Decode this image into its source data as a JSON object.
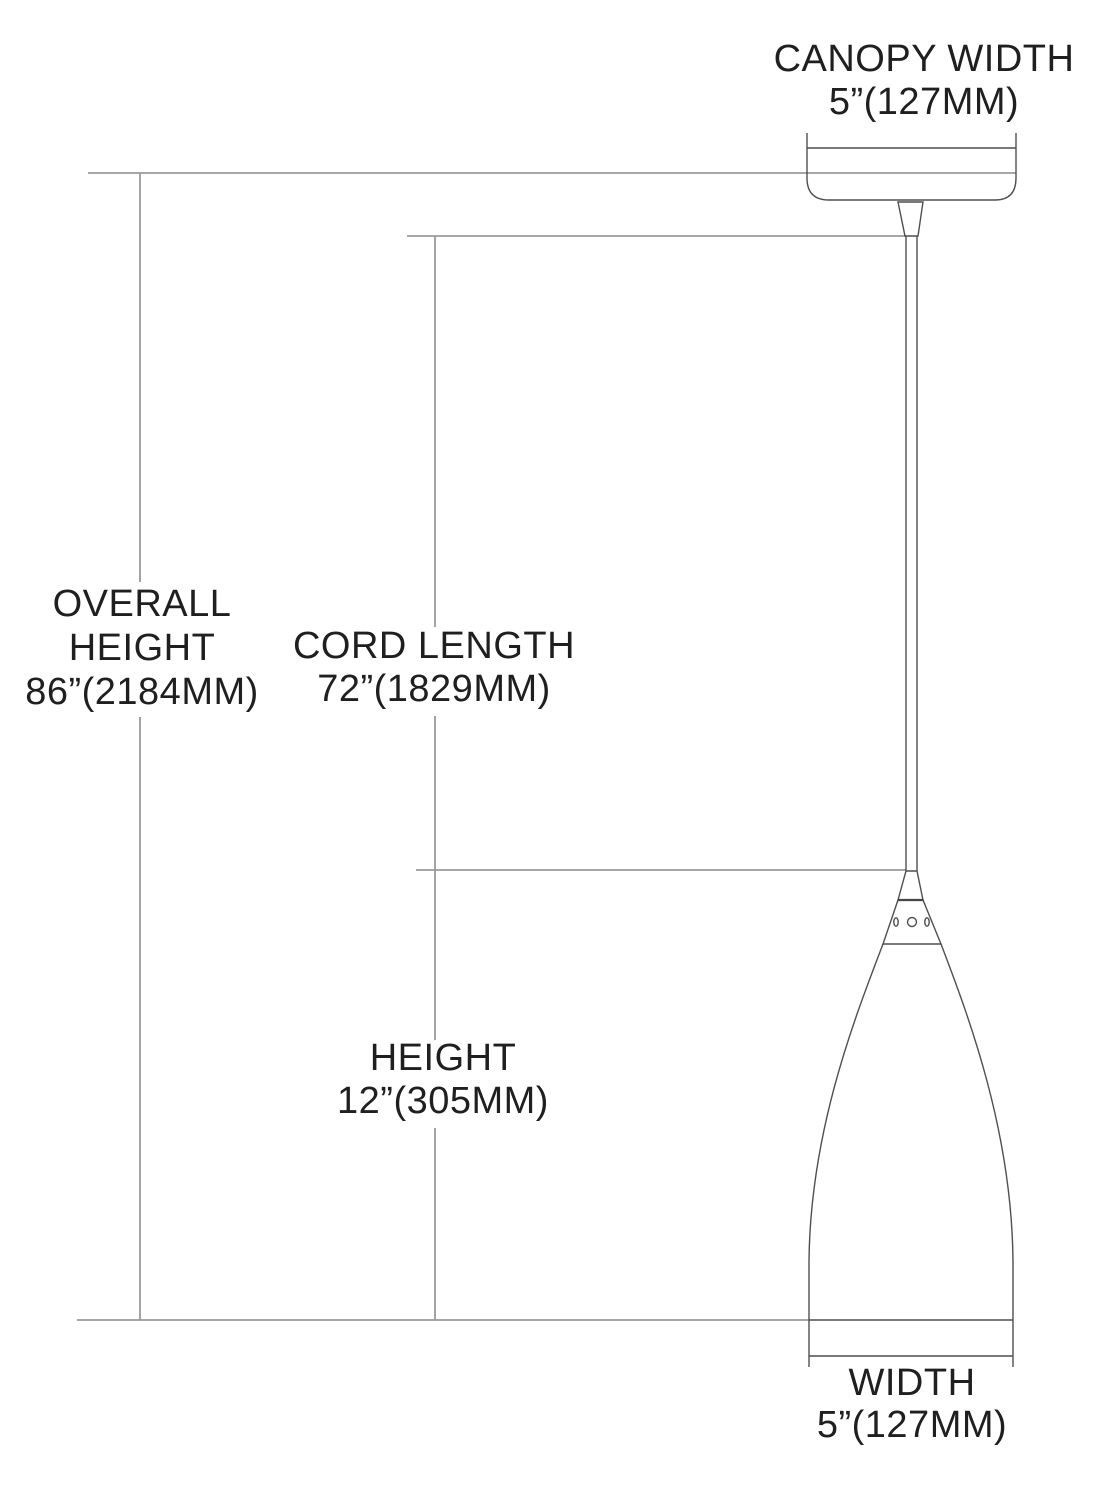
{
  "labels": {
    "canopy_width": {
      "title": "CANOPY WIDTH",
      "value": "5”(127MM)"
    },
    "overall_height": {
      "title_line1": "OVERALL",
      "title_line2": "HEIGHT",
      "value": "86”(2184MM)"
    },
    "cord_length": {
      "title": "CORD LENGTH",
      "value": "72”(1829MM)"
    },
    "shade_height": {
      "title": "HEIGHT",
      "value": "12”(305MM)"
    },
    "shade_width": {
      "title": "WIDTH",
      "value": "5”(127MM)"
    }
  },
  "colors": {
    "background": "#ffffff",
    "text": "#1f1f1f",
    "object_stroke": "#4f4f4f",
    "object_stroke_dark": "#2a2a2a",
    "dimension_stroke": "#999999"
  }
}
